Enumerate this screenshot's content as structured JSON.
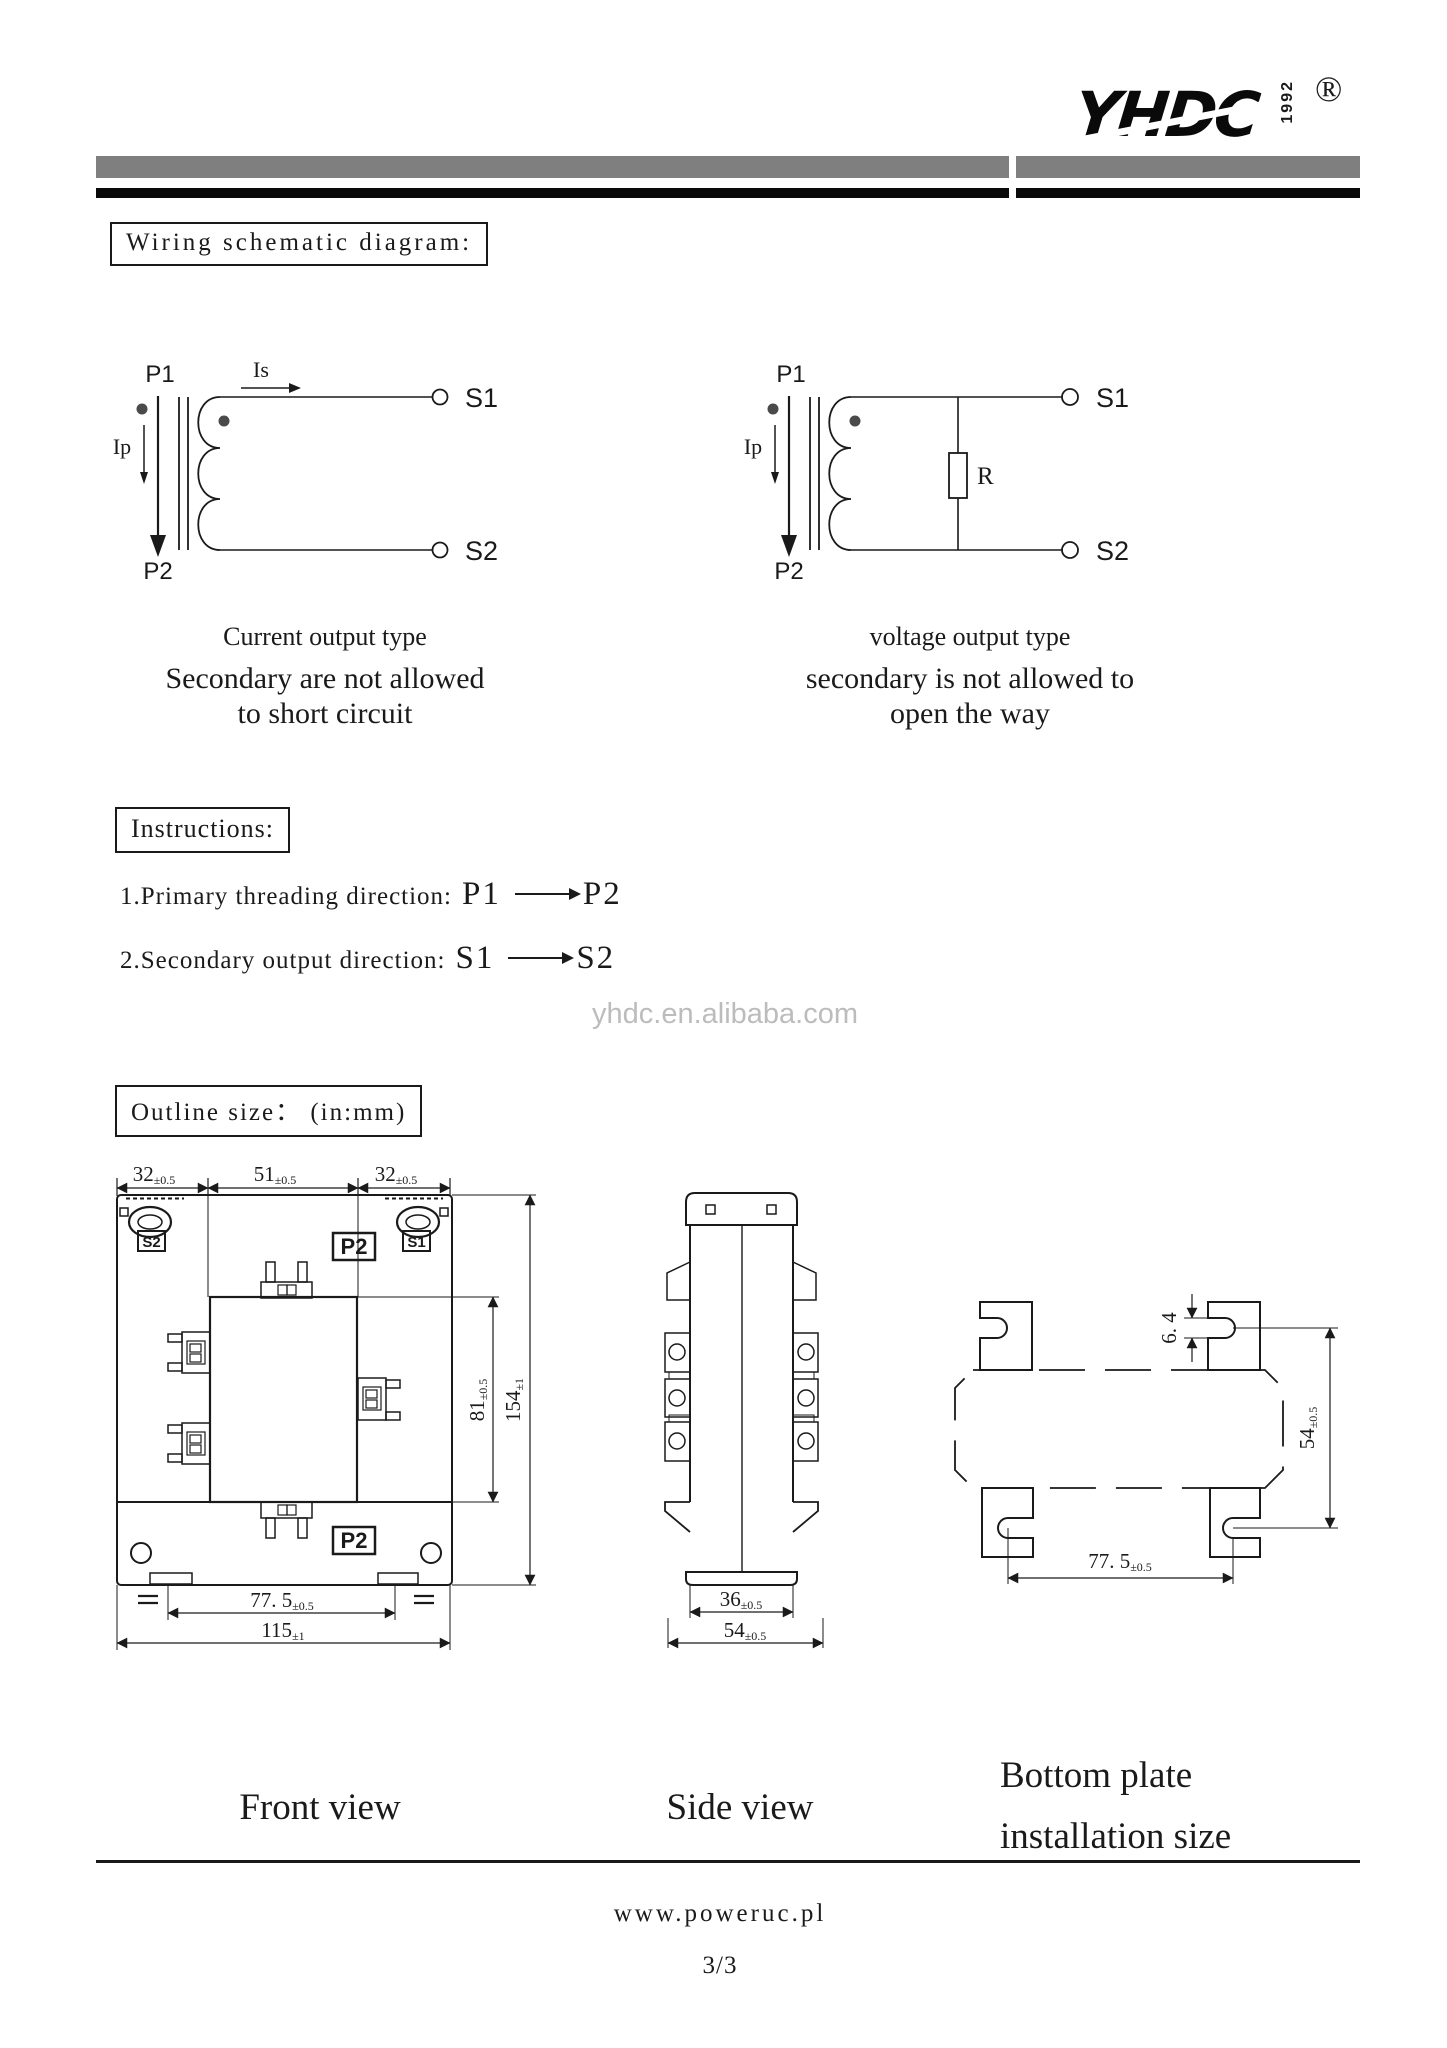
{
  "logo": {
    "brand": "YHDC",
    "year": "1992",
    "registered": "®"
  },
  "titles": {
    "wiring": "Wiring schematic diagram:",
    "instructions": "Instructions:",
    "outline": "Outline size：  (in:mm)"
  },
  "circuits": {
    "left": {
      "p1": "P1",
      "p2": "P2",
      "ip": "Ip",
      "is_label": "Is",
      "s1": "S1",
      "s2": "S2",
      "type": "Current output type",
      "note1": "Secondary are not allowed",
      "note2": "to short circuit"
    },
    "right": {
      "p1": "P1",
      "p2": "P2",
      "ip": "Ip",
      "r": "R",
      "s1": "S1",
      "s2": "S2",
      "type": "voltage output type",
      "note1": "secondary is not allowed to",
      "note2": "open the way"
    }
  },
  "instructions": {
    "item1": {
      "text": "1.Primary threading direction:",
      "from": "P1",
      "to": "P2"
    },
    "item2": {
      "text": "2.Secondary output direction:",
      "from": "S1",
      "to": "S2"
    }
  },
  "watermark": "yhdc.en.alibaba.com",
  "front_view": {
    "caption": "Front view",
    "label_s2": "S2",
    "label_s1": "S1",
    "label_p2_top": "P2",
    "label_p2_bottom": "P2",
    "dim_top_left": {
      "v": "32",
      "t": "±0.5"
    },
    "dim_top_mid": {
      "v": "51",
      "t": "±0.5"
    },
    "dim_top_right": {
      "v": "32",
      "t": "±0.5"
    },
    "dim_inner_height": {
      "v": "81",
      "t": "±0.5"
    },
    "dim_total_height": {
      "v": "154",
      "t": "±1"
    },
    "dim_rail": {
      "v": "77. 5",
      "t": "±0.5"
    },
    "dim_total_width": {
      "v": "115",
      "t": "±1"
    }
  },
  "side_view": {
    "caption": "Side view",
    "dim_body": {
      "v": "36",
      "t": "±0.5"
    },
    "dim_total": {
      "v": "54",
      "t": "±0.5"
    }
  },
  "bottom_plate": {
    "caption1": "Bottom plate",
    "caption2": "installation size",
    "dim_slot": {
      "v": "6. 4"
    },
    "dim_height": {
      "v": "54",
      "t": "±0.5"
    },
    "dim_width": {
      "v": "77. 5",
      "t": "±0.5"
    }
  },
  "footer": {
    "site": "www.poweruc.pl",
    "page": "3/3"
  },
  "colors": {
    "bar_gray": "#7f7f7f",
    "bar_black": "#0a0a0a",
    "watermark": "#bcbcbc"
  }
}
